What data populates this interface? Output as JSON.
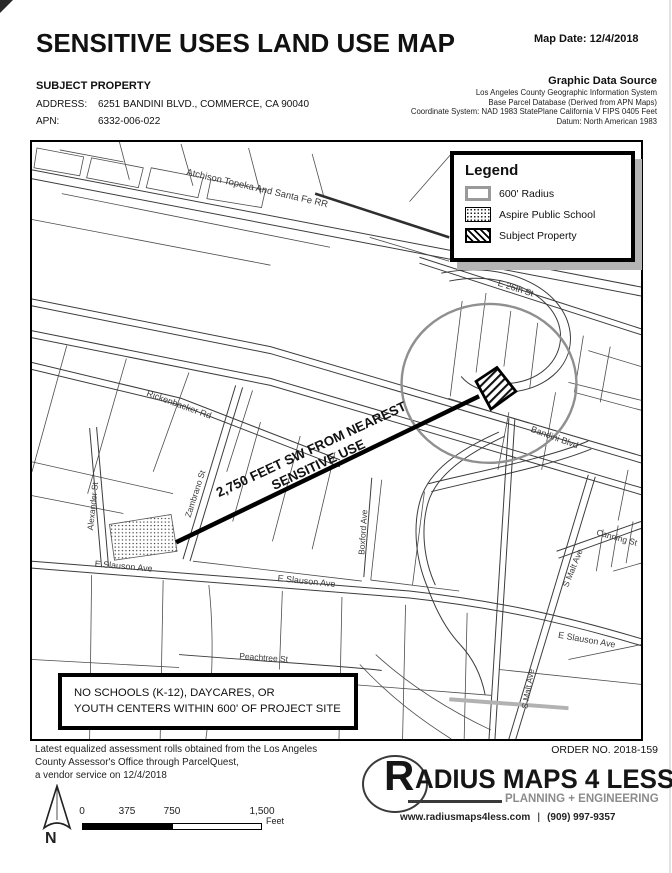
{
  "header": {
    "title": "SENSITIVE USES LAND USE MAP",
    "map_date": "Map Date: 12/4/2018",
    "subject_heading": "SUBJECT PROPERTY",
    "address_label": "ADDRESS:",
    "address_value": "6251 BANDINI BLVD., COMMERCE, CA 90040",
    "apn_label": "APN:",
    "apn_value": "6332-006-022",
    "data_source": {
      "heading": "Graphic Data Source",
      "line1": "Los Angeles County Geographic Information System",
      "line2": "Base Parcel Database  (Derived from APN Maps)",
      "line3": "Coordinate System: NAD 1983 StatePlane California V FIPS 0405 Feet",
      "line4": "Datum: North American 1983"
    }
  },
  "legend": {
    "title": "Legend",
    "items": [
      {
        "label": "600' Radius"
      },
      {
        "label": "Aspire Public School"
      },
      {
        "label": "Subject Property"
      }
    ]
  },
  "map": {
    "streets": {
      "railroad": "Atchison Topeka And Santa Fe RR",
      "e26th": "E 26th St",
      "bandini": "Bandini Blvd",
      "rickenbacker": "Rickenbacker Rd",
      "alexander": "Alexander St",
      "zambrano": "Zambrano St",
      "boxford": "Boxford Ave",
      "slauson": "E Slauson Ave",
      "canning": "Canning St",
      "malt": "S Malt Ave",
      "peachtree": "Peachtree St",
      "freeway_fragment": "5"
    },
    "annotation": {
      "line1": "2,750 FEET SW FROM NEAREST",
      "line2": "SENSITIVE USE"
    },
    "note": {
      "line1": "NO SCHOOLS (K-12), DAYCARES, OR",
      "line2": "YOUTH CENTERS WITHIN 600' OF PROJECT SITE"
    }
  },
  "footer": {
    "disclaimer_line1": "Latest equalized assessment rolls obtained from the Los Angeles",
    "disclaimer_line2": "County Assessor's Office through ParcelQuest,",
    "disclaimer_line3": "a vendor service on 12/4/2018",
    "order_no": "ORDER NO. 2018-159",
    "logo": {
      "initial": "R",
      "name_rest": "ADIUS MAPS 4 LESS",
      "tagline": "PLANNING + ENGINEERING",
      "website": "www.radiusmaps4less.com",
      "separator": "|",
      "phone": "(909) 997-9357"
    },
    "north_label": "N",
    "scale": {
      "t0": "0",
      "t375": "375",
      "t750": "750",
      "t1500": "1,500",
      "unit": "Feet"
    }
  },
  "colors": {
    "radius_circle": "#8f8f8f",
    "distance_line": "#000000",
    "legend_shadow": "#b4b4b4",
    "parcel_line": "#4c4c4c"
  }
}
